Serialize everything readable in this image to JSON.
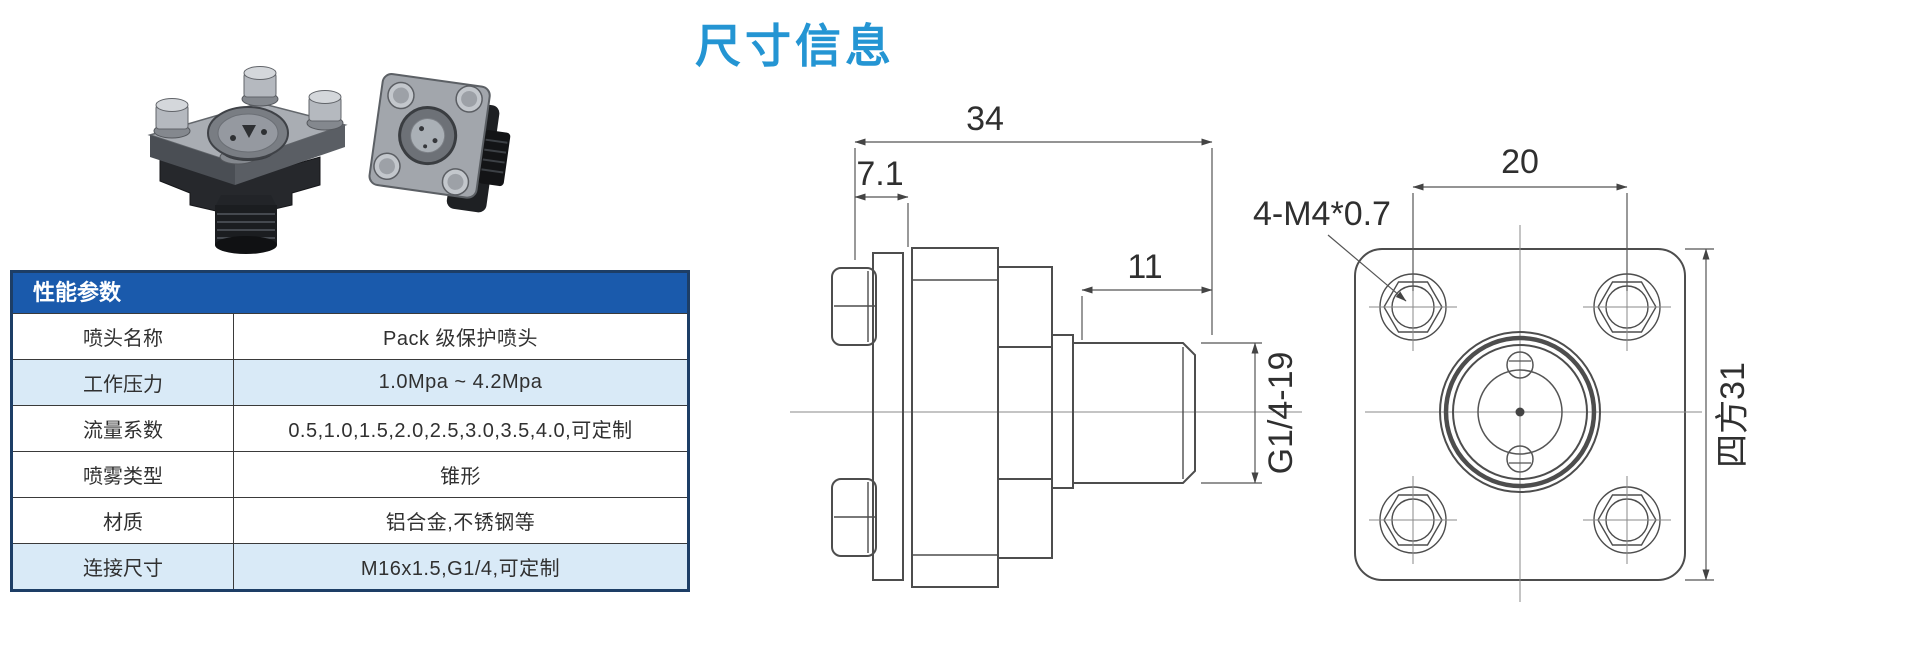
{
  "page": {
    "title": "尺寸信息"
  },
  "theme": {
    "title_blue": "#2495d3",
    "table_header_blue": "#1a5aac",
    "table_border_navy": "#1d3e66",
    "row_tint_blue": "#d9eaf7"
  },
  "spec_table": {
    "header": "性能参数",
    "rows": [
      {
        "label": "喷头名称",
        "value": "Pack 级保护喷头"
      },
      {
        "label": "工作压力",
        "value": "1.0Mpa ~ 4.2Mpa"
      },
      {
        "label": "流量系数",
        "value": "0.5,1.0,1.5,2.0,2.5,3.0,3.5,4.0,可定制"
      },
      {
        "label": "喷雾类型",
        "value": "锥形"
      },
      {
        "label": "材质",
        "value": "铝合金,不锈钢等"
      },
      {
        "label": "连接尺寸",
        "value": "M16x1.5,G1/4,可定制"
      }
    ]
  },
  "drawing": {
    "side_view": {
      "overall_width": "34",
      "flange_offset": "7.1",
      "thread_length": "11",
      "thread_spec": "G1/4-19"
    },
    "front_view": {
      "bolt_spacing": "20",
      "bolt_thread_label": "4-M4*0.7",
      "square_size": "四方31"
    }
  }
}
